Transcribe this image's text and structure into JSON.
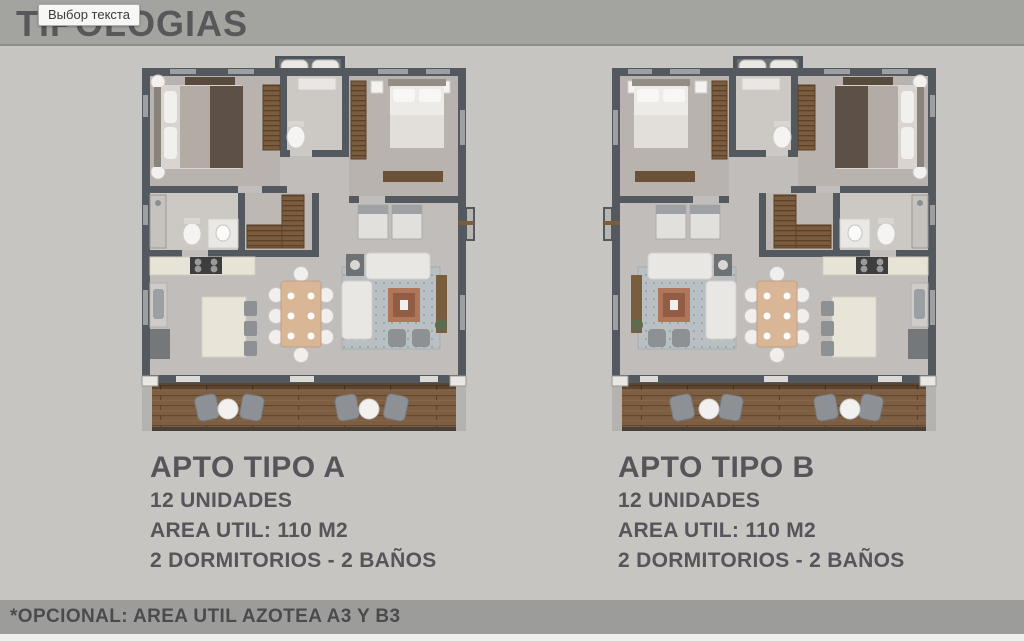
{
  "header": {
    "title": "TIPOLOGIAS"
  },
  "tooltip": {
    "text": "Выбор текста"
  },
  "apartments": [
    {
      "name": "APTO TIPO A",
      "units": "12 UNIDADES",
      "area": "AREA UTIL: 110 M2",
      "bedrooms": "2 DORMITORIOS - 2 BAÑOS"
    },
    {
      "name": "APTO TIPO B",
      "units": "12 UNIDADES",
      "area": "AREA UTIL: 110 M2",
      "bedrooms": "2 DORMITORIOS - 2 BAÑOS"
    }
  ],
  "footer": {
    "note": "*OPCIONAL: AREA UTIL AZOTEA A3 Y B3"
  },
  "colors": {
    "background": "#c7c5c2",
    "top_band": "#a3a3a0",
    "footer_band": "#9c9c9a",
    "title_text": "#58585a",
    "body_text": "#55555a",
    "footer_text": "#4b4b4e",
    "wall": "#54595f",
    "floor": "#c1bdba",
    "bedroom_floor": "#b8b3ae",
    "bathroom_floor": "#ccc8c4",
    "wood_furniture": "#7a5c3e",
    "deck_wood": "#7d5e42",
    "rug": "#b9c0c4",
    "coffee_table": "#b0765a",
    "dining_table": "#d8b696",
    "sofa": "#e9e7e3",
    "chair_gray": "#8d9094"
  }
}
